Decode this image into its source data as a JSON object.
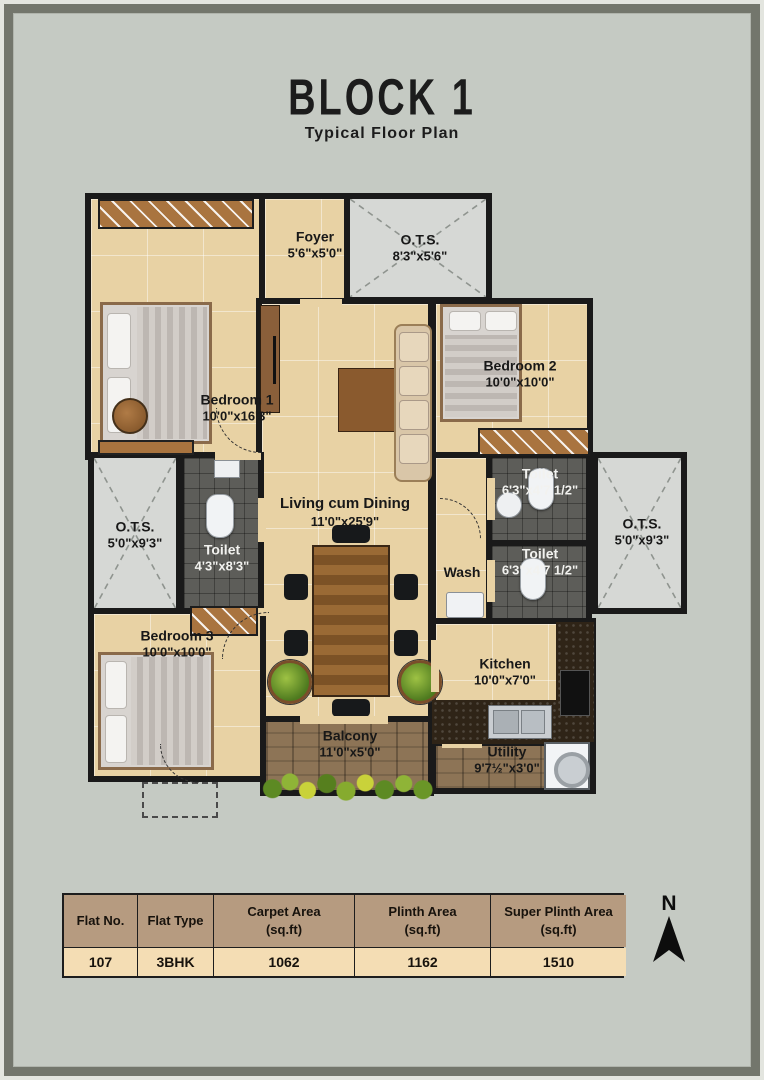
{
  "title": {
    "block": "BLOCK 1",
    "subtitle": "Typical Floor Plan"
  },
  "rooms": {
    "foyer": {
      "name": "Foyer",
      "dim": "5'6\"x5'0\""
    },
    "ots_top": {
      "name": "O.T.S.",
      "dim": "8'3\"x5'6\""
    },
    "bedroom1": {
      "name": "Bedroom 1",
      "dim": "10'0\"x16'3\""
    },
    "bedroom2": {
      "name": "Bedroom 2",
      "dim": "10'0\"x10'0\""
    },
    "toilet_right_top": {
      "name": "Toilet",
      "dim": "6'3\"x4'7 1/2\""
    },
    "toilet_right_bot": {
      "name": "Toilet",
      "dim": "6'3\"x4'7 1/2\""
    },
    "toilet_common": {
      "name": "Toilet",
      "dim": "4'3\"x8'3\""
    },
    "ots_left": {
      "name": "O.T.S.",
      "dim": "5'0\"x9'3\""
    },
    "ots_right": {
      "name": "O.T.S.",
      "dim": "5'0\"x9'3\""
    },
    "living_dining": {
      "name": "Living cum Dining",
      "dim": "11'0\"x25'9\""
    },
    "wash": {
      "name": "Wash",
      "dim": ""
    },
    "bedroom3": {
      "name": "Bedroom 3",
      "dim": "10'0\"x10'0\""
    },
    "kitchen": {
      "name": "Kitchen",
      "dim": "10'0\"x7'0\""
    },
    "balcony": {
      "name": "Balcony",
      "dim": "11'0\"x5'0\""
    },
    "utility": {
      "name": "Utility",
      "dim": "9'7½\"x3'0\""
    }
  },
  "table": {
    "columns": [
      {
        "label": "Flat No.",
        "unit": ""
      },
      {
        "label": "Flat Type",
        "unit": ""
      },
      {
        "label": "Carpet Area",
        "unit": "(sq.ft)"
      },
      {
        "label": "Plinth Area",
        "unit": "(sq.ft)"
      },
      {
        "label": "Super Plinth Area",
        "unit": "(sq.ft)"
      }
    ],
    "values": [
      "107",
      "3BHK",
      "1062",
      "1162",
      "1510"
    ]
  },
  "compass": {
    "label": "N"
  },
  "colors": {
    "wall": "#1a1a1a",
    "floor": "#e8d2a4",
    "ots": "#d6d8d5",
    "toilet_floor": "#5d5d59",
    "wood": "#8d7456",
    "counter": "#2f2417",
    "table_header": "#b69b80",
    "table_row": "#f4ddb4",
    "background": "#c5cac3",
    "frame": "#73766c"
  }
}
